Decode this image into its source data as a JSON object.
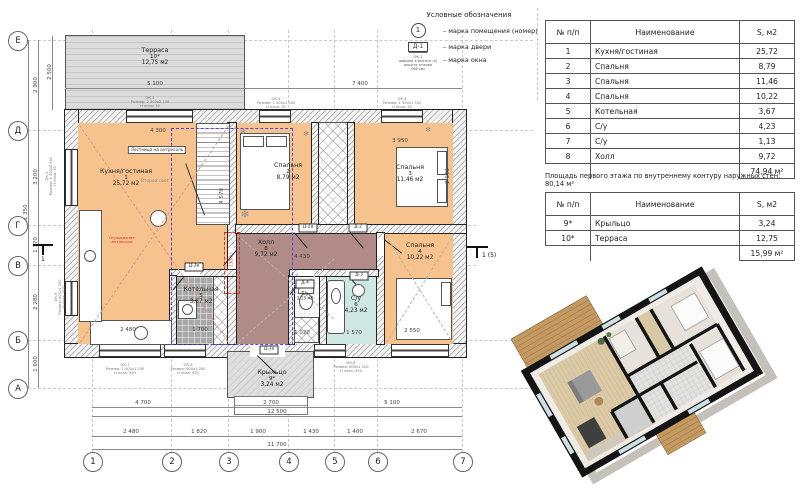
{
  "colors": {
    "room_orange": "#f6c38e",
    "hall_mauve": "#b08b87",
    "boiler_gray": "#a8a8a8",
    "wc_teal": "#cfe7e3",
    "terrace_gray": "#d9d9d9",
    "mezzanine_blue": "#5b3fd4",
    "accent_red": "#d0342c"
  },
  "legend": {
    "title": "Условные обозначения",
    "room_mark": "1",
    "room_mark_label": "– марка помещения (номер)",
    "door_mark": "Д-1",
    "door_mark_label": "– марка двери",
    "window_mark": "ОК-1\nширина х высота (h)\nвысота отлива\n060 мм",
    "window_mark_label": "– марка окна"
  },
  "area_table": {
    "headers": [
      "№ п/п",
      "Наименование",
      "S, м2"
    ],
    "rows": [
      [
        "1",
        "Кухня/гостиная",
        "25,72"
      ],
      [
        "2",
        "Спальня",
        "8,79"
      ],
      [
        "3",
        "Спальня",
        "11,46"
      ],
      [
        "4",
        "Спальня",
        "10,22"
      ],
      [
        "5",
        "Котельная",
        "3,67"
      ],
      [
        "6",
        "С/у",
        "4,23"
      ],
      [
        "7",
        "С/у",
        "1,13"
      ],
      [
        "8",
        "Холл",
        "9,72"
      ]
    ],
    "total": "74,94 м²"
  },
  "area_note": "Площадь первого этажа по внутреннему контуру наружных стен: 80,14 м²",
  "outdoor_table": {
    "headers": [
      "№ п/п",
      "Наименование",
      "S, м2"
    ],
    "rows": [
      [
        "9*",
        "Крыльцо",
        "3,24"
      ],
      [
        "10*",
        "Терраса",
        "12,75"
      ]
    ],
    "total": "15,99 м²"
  },
  "plan": {
    "rooms": {
      "kitchen": {
        "name": "Кухня/гостиная",
        "num": "1",
        "area": "25,72 м2"
      },
      "bedroom2": {
        "name": "Спальня",
        "num": "2",
        "area": "8,79 м2"
      },
      "bedroom3": {
        "name": "Спальня",
        "num": "3",
        "area": "11,46 м2"
      },
      "bedroom4": {
        "name": "Спальня",
        "num": "4",
        "area": "10,22 м2"
      },
      "boiler": {
        "name": "Котельная",
        "num": "5",
        "area": "3,67 м2"
      },
      "su6": {
        "name": "С/у",
        "num": "6",
        "area": "4,23 м2"
      },
      "su7": {
        "name": "С/у",
        "num": "7",
        "area": "1,13 м2"
      },
      "hall": {
        "name": "Холл",
        "num": "8",
        "area": "9,72 м2"
      },
      "porch": {
        "name": "Крыльцо",
        "num": "9*",
        "area": "3,24 м2"
      },
      "terrace": {
        "name": "Терраса",
        "num": "10*",
        "area": "12,75 м2"
      }
    },
    "axis_letters": [
      "Е",
      "Д",
      "Г",
      "В",
      "Б",
      "А"
    ],
    "axis_numbers": [
      "1",
      "2",
      "3",
      "4",
      "5",
      "6",
      "7"
    ],
    "dims": {
      "left": [
        "2 900",
        "3 200",
        "1 370",
        "2 280",
        "1 600"
      ],
      "left_total": "11 350",
      "terrace_h": "2 500",
      "top": [
        "5 100",
        "7 400"
      ],
      "bottom_row1": [
        "4 700",
        "2 700",
        "5 100"
      ],
      "bottom_row1_total": "12 500",
      "bottom_row2": [
        "2 480",
        "1 820",
        "1 900",
        "1 430",
        "1 400",
        "2 670"
      ],
      "bottom_total": "11 700",
      "interior": [
        "4 300",
        "3 950",
        "2 900",
        "4 430",
        "2 550",
        "1 570",
        "1 020",
        "2 480",
        "1 700",
        "4 570"
      ]
    },
    "notes": {
      "stair": "Лестница на антресоль",
      "second_light": "Второй свет",
      "mezzanine_rail": "Ограждение\nантресоли",
      "red_height": "1 130(h)",
      "section_right": "1 (5)",
      "section_left": "1"
    },
    "door_marks": [
      "Д-2а",
      "Д-2",
      "Д-3а",
      "Д-4",
      "Д-3",
      "Д-1а"
    ],
    "window_notes": [
      "ОК-3\nРазмер: 2 300х2 100\nН низа: 30",
      "ОК-4\nРазмер: 1 500х1 500\nН низа: 20",
      "ОК-4\nРазмер: 1 500х1 500\nН низа: 20",
      "ОК-7\nРазмер: 1 400х1 200\nН низа: 920",
      "ОК-8\nРазмер: 800х1 200\nН низа: 920",
      "ОК-8\nРазмер: 800х1 200\nН низа: 920",
      "ОК-1\nРазмер: 1 300х2 100\nН низа: 30",
      "ОК-6\nРазмер: 800х1 200\nН низа: 920"
    ]
  }
}
